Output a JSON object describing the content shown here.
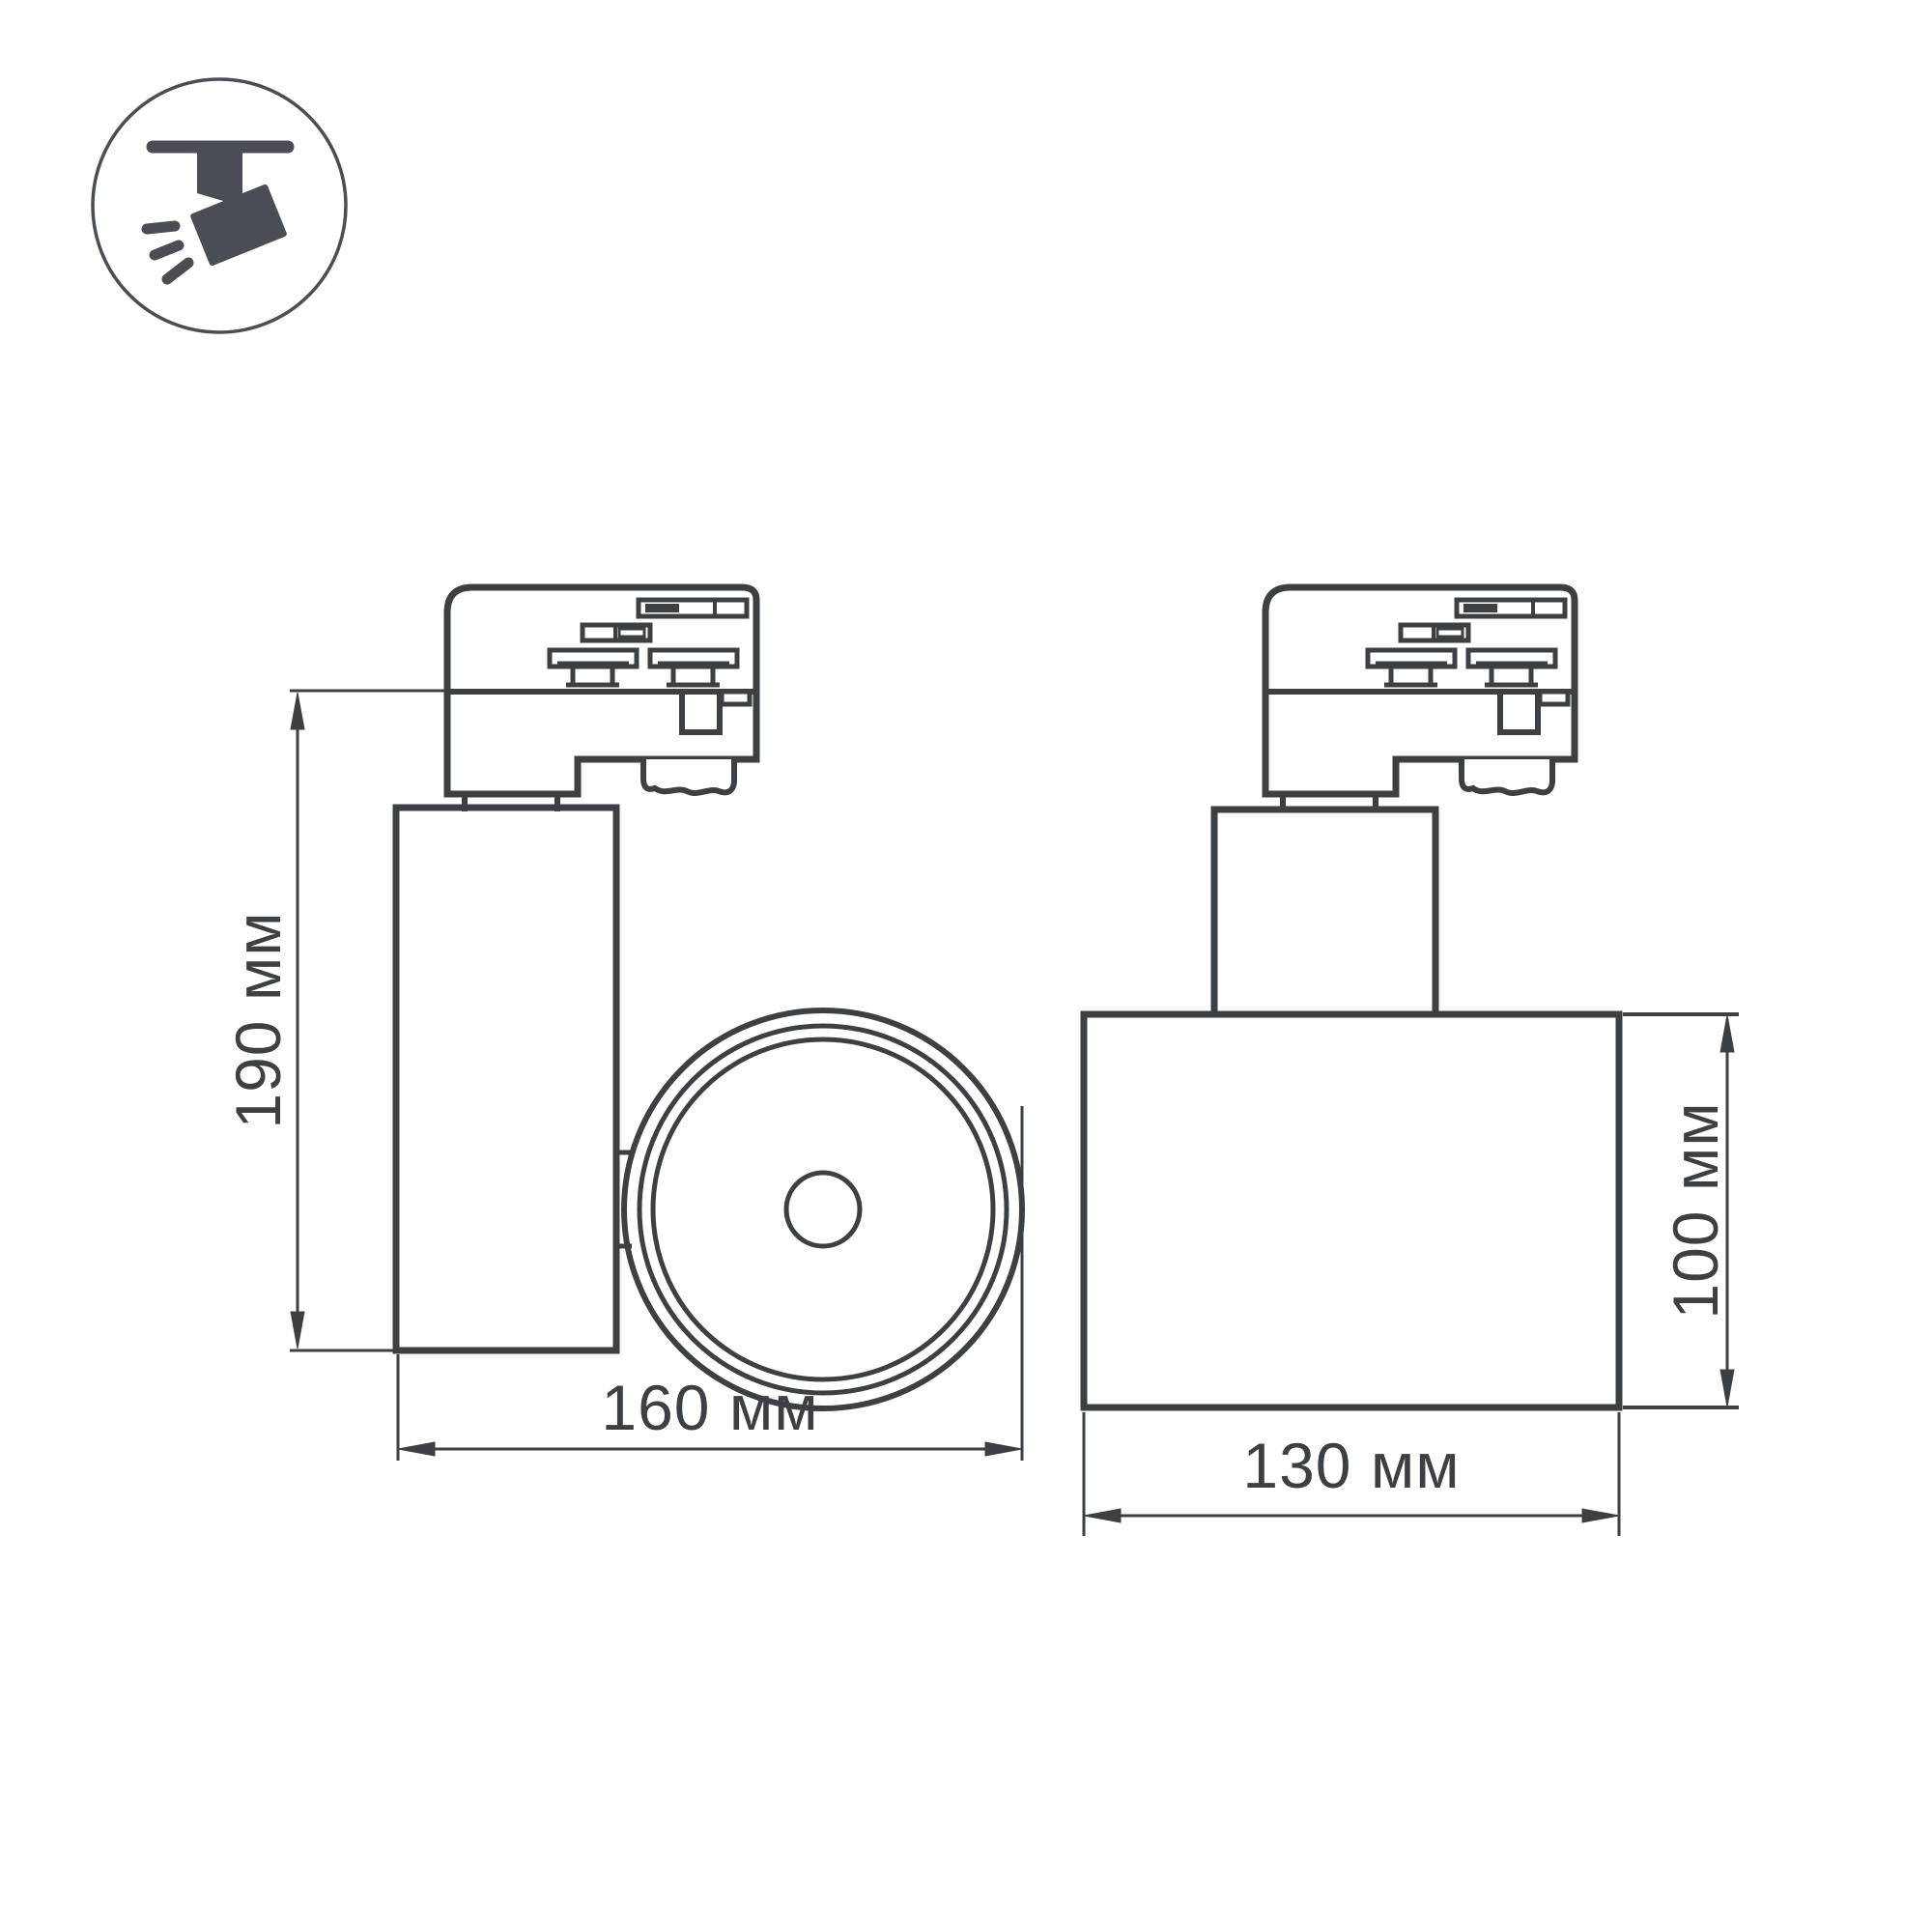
{
  "colors": {
    "background": "#ffffff",
    "drawing_line": "#3c4043",
    "icon_color": "#4a4e54"
  },
  "icon": {
    "name": "track-spotlight-icon"
  },
  "views": {
    "side": {
      "height_label": "190 мм",
      "width_label": "160 мм"
    },
    "front": {
      "height_label": "100 мм",
      "width_label": "130 мм"
    }
  }
}
